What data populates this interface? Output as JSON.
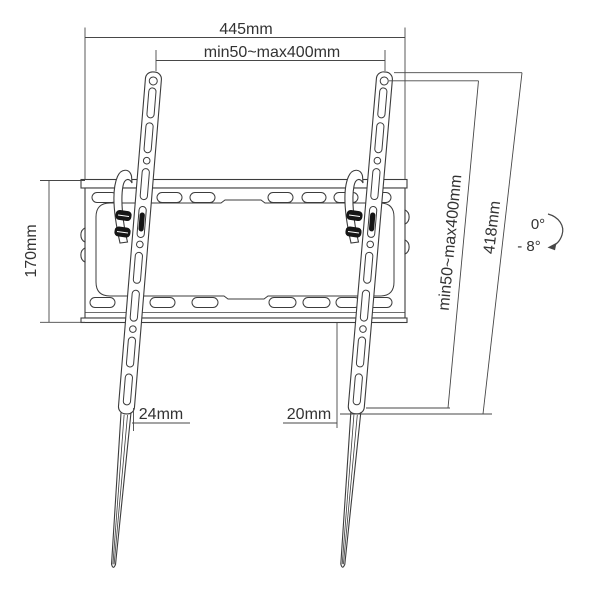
{
  "drawing": {
    "title": "Tilting TV wall-mount bracket technical drawing",
    "dims": {
      "overall_width": "445mm",
      "vesa_width": "min50~max400mm",
      "plate_height": "170mm",
      "vesa_height": "min50~max400mm",
      "bracket_length": "418mm",
      "left_bottom_offset": "24mm",
      "right_bottom_offset": "20mm",
      "tilt_upper": "0°",
      "tilt_lower": "- 8°"
    },
    "colors": {
      "line": "#3c3c3c",
      "dimension_line": "#474747",
      "text": "#333333",
      "hardware": "#161616",
      "background": "#ffffff"
    },
    "icons": [
      "tilt-arc-arrow-icon"
    ]
  }
}
